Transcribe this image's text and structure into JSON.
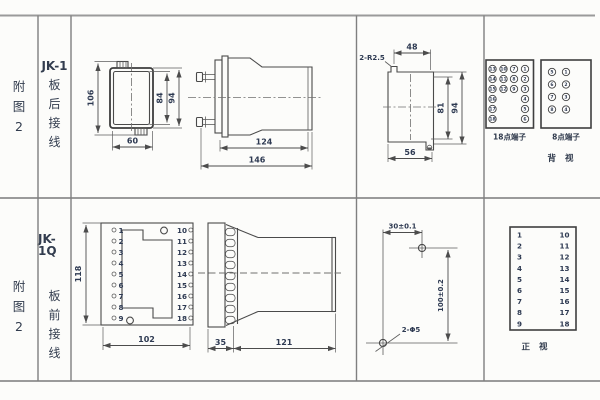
{
  "top": {
    "fig": [
      "附",
      "图",
      "2"
    ],
    "model": "JK-1",
    "wiring": [
      "板",
      "后",
      "接",
      "线"
    ],
    "front": {
      "h106": "106",
      "h84": "84",
      "h94": "94",
      "w60": "60"
    },
    "side": {
      "l124": "124",
      "l146": "146"
    },
    "cutout": {
      "r": "2-R2.5",
      "w48": "48",
      "h81": "81",
      "h94": "94",
      "w56": "56"
    },
    "t18": {
      "label": "18点端子",
      "a": [
        "13",
        "14",
        "15",
        "16",
        "17",
        "18"
      ],
      "b": [
        "10",
        "11",
        "12"
      ],
      "c": [
        "7",
        "8",
        "9"
      ],
      "d": [
        "1",
        "2",
        "3",
        "4",
        "5",
        "6"
      ]
    },
    "t8": {
      "label": "8点端子",
      "l": [
        "5",
        "6",
        "7",
        "8"
      ],
      "r": [
        "1",
        "2",
        "3",
        "4"
      ]
    },
    "back_label": "背 视"
  },
  "bot": {
    "fig": [
      "附",
      "图",
      "2"
    ],
    "model": "JK-1Q",
    "wiring": [
      "板",
      "前",
      "接",
      "线"
    ],
    "front": {
      "h118": "118",
      "w102": "102",
      "left": [
        "1",
        "2",
        "3",
        "4",
        "5",
        "6",
        "7",
        "8",
        "9"
      ],
      "right": [
        "10",
        "11",
        "12",
        "13",
        "14",
        "15",
        "16",
        "17",
        "18"
      ]
    },
    "side": {
      "w35": "35",
      "l121": "121"
    },
    "drill": {
      "dh": "30±0.1",
      "dv": "100±0.2",
      "holes": "2-Φ5"
    },
    "table": {
      "left": [
        "1",
        "2",
        "3",
        "4",
        "5",
        "6",
        "7",
        "8",
        "9"
      ],
      "right": [
        "10",
        "11",
        "12",
        "13",
        "14",
        "15",
        "16",
        "17",
        "18"
      ]
    },
    "front_label": "正 视"
  }
}
